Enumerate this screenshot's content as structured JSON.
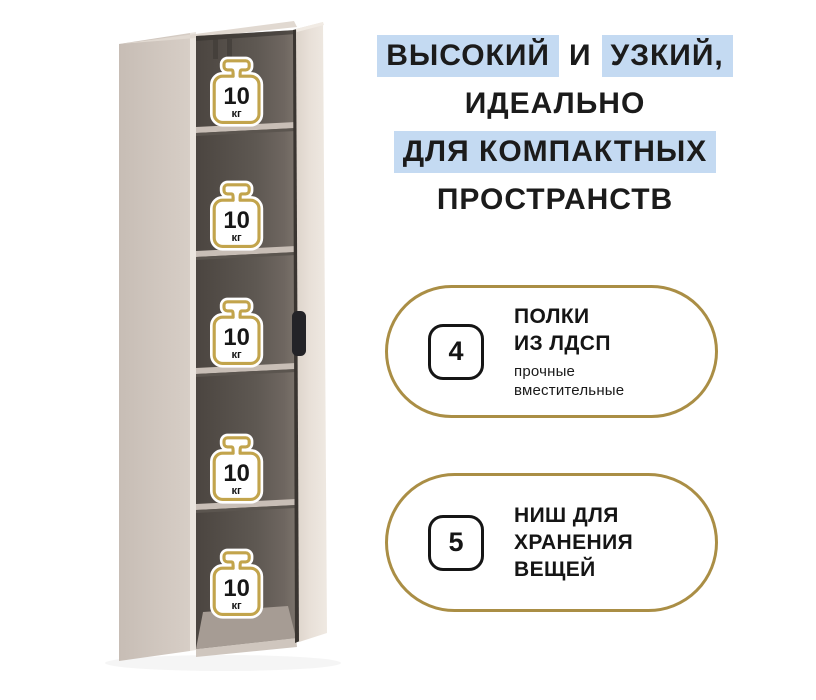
{
  "colors": {
    "highlight_blue": "#c4daf2",
    "gold_badge_border": "#aa8e45",
    "gold_icon_outline": "#c2a44c",
    "text_dark": "#1b1b1b",
    "cabinet_side": "#cdc3bb",
    "cabinet_interior": "#5e5852",
    "cabinet_door": "#e8e0d8",
    "door_handle": "#232327"
  },
  "headline": {
    "part1_highlight": "ВЫСОКИЙ",
    "part2_plain": "И",
    "part3_highlight": "УЗКИЙ,",
    "line2": "ИДЕАЛЬНО",
    "line3_highlight": "ДЛЯ КОМПАКТНЫХ",
    "line4": "ПРОСТРАНСТВ"
  },
  "shelf_load_badge": {
    "value": "10",
    "unit": "кг",
    "count": 5
  },
  "features": [
    {
      "number": "4",
      "title_lines": [
        "ПОЛКИ",
        "ИЗ ЛДСП"
      ],
      "subtitle_lines": [
        "прочные",
        "вместительные"
      ]
    },
    {
      "number": "5",
      "title_lines": [
        "НИШ ДЛЯ",
        "ХРАНЕНИЯ",
        "ВЕЩЕЙ"
      ],
      "subtitle_lines": []
    }
  ]
}
